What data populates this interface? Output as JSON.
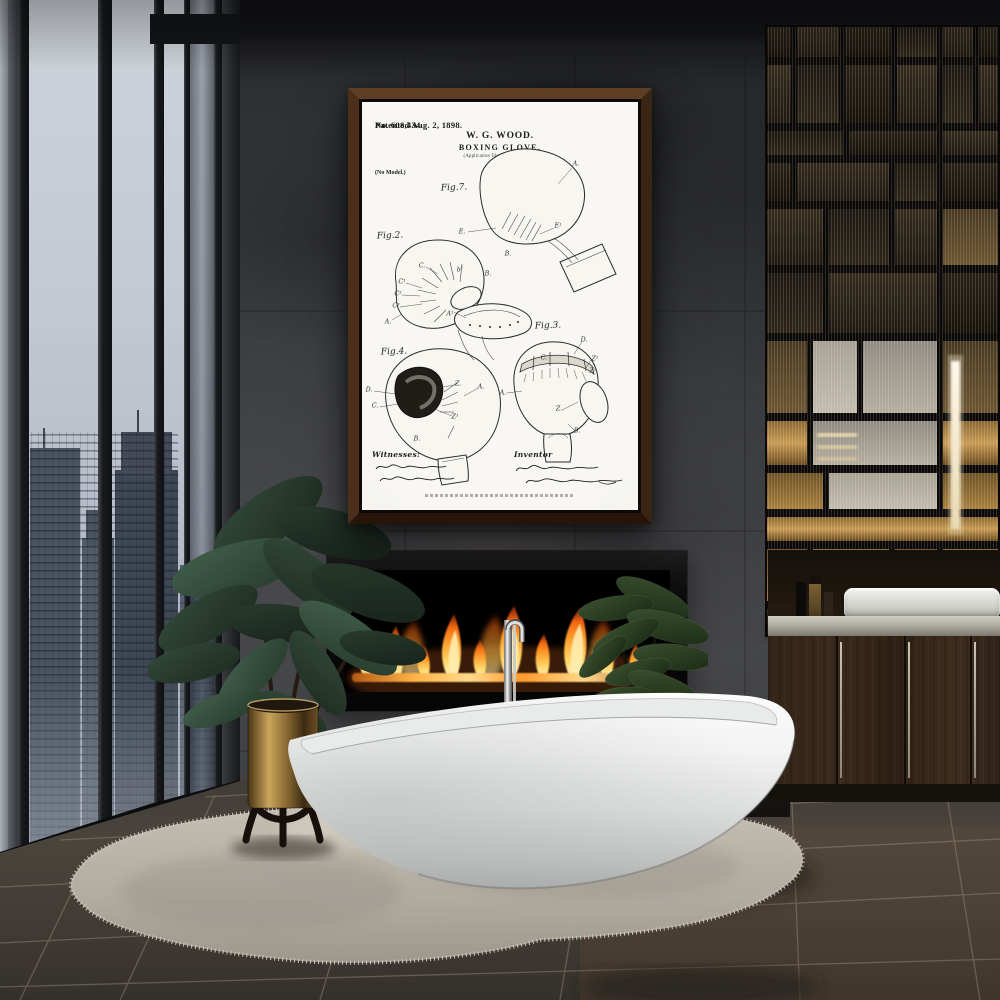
{
  "poster": {
    "patent_number": "No. 608,434.",
    "patent_date": "Patented Aug. 2, 1898.",
    "inventor_name": "W. G. WOOD.",
    "title": "BOXING GLOVE.",
    "application_line": "(Application filed Sept. 24, 1897.)",
    "model_note": "(No Model.)",
    "witnesses_label": "Witnesses:",
    "inventor_label": "Inventor",
    "figures": [
      {
        "id": "fig7",
        "label": "Fig.7.",
        "label_pos": [
          92,
          86
        ],
        "annotations": [
          {
            "t": "A.",
            "x": 214,
            "y": 62
          },
          {
            "t": "E.",
            "x": 100,
            "y": 130
          },
          {
            "t": "E¹",
            "x": 196,
            "y": 124
          },
          {
            "t": "B.",
            "x": 146,
            "y": 152
          }
        ]
      },
      {
        "id": "fig2",
        "label": "Fig.2.",
        "label_pos": [
          28,
          134
        ],
        "annotations": [
          {
            "t": "C.",
            "x": 60,
            "y": 164
          },
          {
            "t": "C¹",
            "x": 40,
            "y": 180
          },
          {
            "t": "C²",
            "x": 36,
            "y": 192
          },
          {
            "t": "C³",
            "x": 34,
            "y": 204
          },
          {
            "t": "A.",
            "x": 26,
            "y": 220
          },
          {
            "t": "A¹",
            "x": 88,
            "y": 212
          },
          {
            "t": "b″",
            "x": 98,
            "y": 168
          },
          {
            "t": "B.",
            "x": 126,
            "y": 172
          }
        ]
      },
      {
        "id": "fig4",
        "label": "Fig.4.",
        "label_pos": [
          32,
          250
        ],
        "annotations": [
          {
            "t": "D.",
            "x": 7,
            "y": 288
          },
          {
            "t": "C.",
            "x": 13,
            "y": 304
          },
          {
            "t": "Z.",
            "x": 96,
            "y": 282
          },
          {
            "t": "Z¹",
            "x": 93,
            "y": 315
          },
          {
            "t": "B.",
            "x": 55,
            "y": 337
          },
          {
            "t": "A.",
            "x": 119,
            "y": 285
          }
        ]
      },
      {
        "id": "fig3",
        "label": "Fig.3.",
        "label_pos": [
          186,
          224
        ],
        "annotations": [
          {
            "t": "D.",
            "x": 222,
            "y": 238
          },
          {
            "t": "Z¹",
            "x": 233,
            "y": 257
          },
          {
            "t": "Z²",
            "x": 231,
            "y": 269
          },
          {
            "t": "C.",
            "x": 182,
            "y": 256
          },
          {
            "t": "A.",
            "x": 141,
            "y": 291
          },
          {
            "t": "Z.",
            "x": 197,
            "y": 307
          },
          {
            "t": "B.",
            "x": 215,
            "y": 329
          }
        ]
      }
    ]
  },
  "colors": {
    "wall_charcoal": "#3c3e42",
    "ceiling": "#121315",
    "sky": "#c7ccd4",
    "skyline_building": "#49525f",
    "flame_core": "#fff3c4",
    "flame_mid": "#ffae3c",
    "flame_deep": "#f26712",
    "frame_walnut": "#4a2d18",
    "paper_white": "#f6f5f0",
    "ink": "#1c1c1c",
    "tub_white": "#f3f4f3",
    "rug_grey": "#bdb7ac",
    "floor_brown": "#46403a",
    "amber_glass": "#a8813f",
    "brass_planter": "#b9924c",
    "leaf_green": "#2f4636",
    "counter_stone": "#b9b7b0",
    "cabinet_wood": "#35251a",
    "chrome": "#d9d9d9"
  }
}
